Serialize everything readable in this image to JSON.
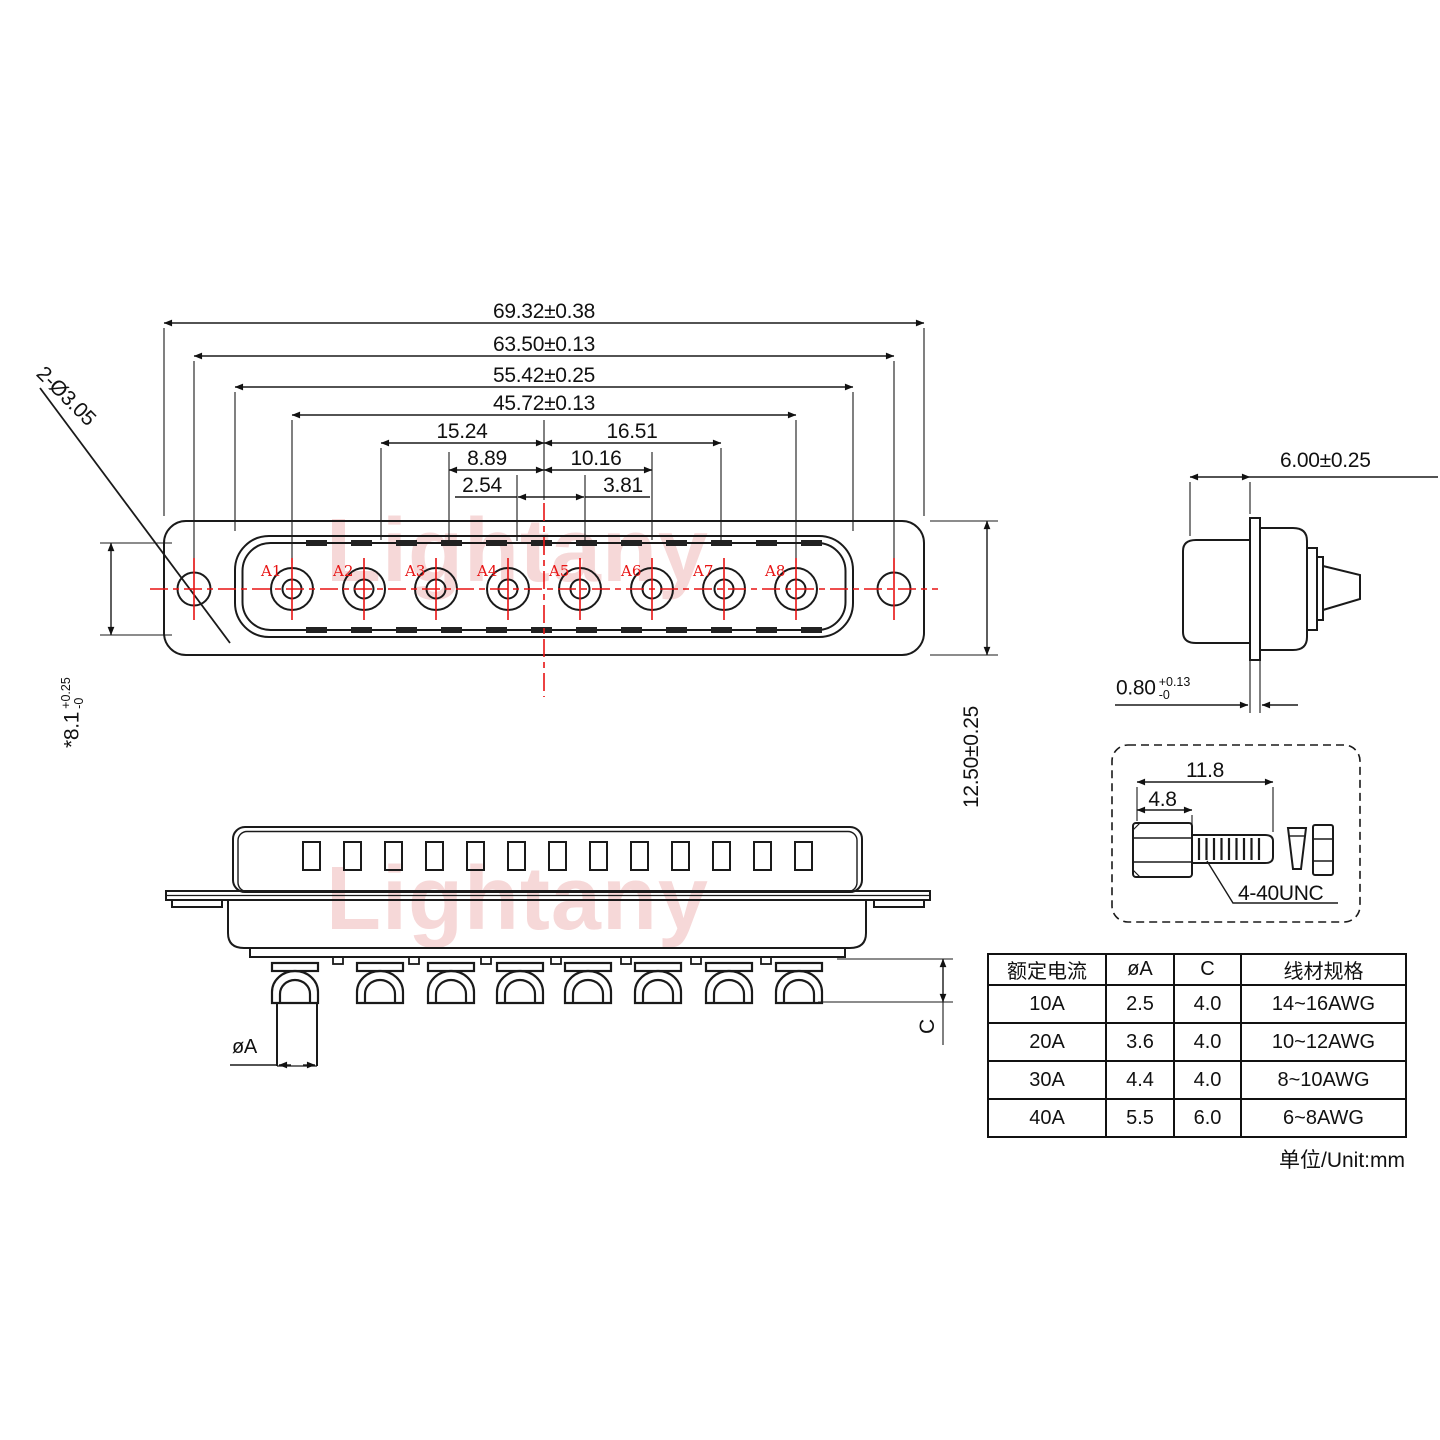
{
  "drawing": {
    "front_view": {
      "dims": {
        "overall": "69.32±0.38",
        "mount": "63.50±0.13",
        "shell": "55.42±0.25",
        "pins_span": "45.72±0.13",
        "p3_left": "15.24",
        "p3_right": "16.51",
        "p2_left": "8.89",
        "p2_right": "10.16",
        "p1_left": "2.54",
        "p1_right": "3.81",
        "mount_holes": "2-Ø3.05",
        "flange_height": "12.50±0.25",
        "shell_height": "*8.1",
        "shell_height_tol_plus": "+0.25",
        "shell_height_tol_minus": "-0"
      },
      "pins": [
        "A1",
        "A2",
        "A3",
        "A4",
        "A5",
        "A6",
        "A7",
        "A8"
      ]
    },
    "side_view": {
      "depth": "6.00±0.25",
      "flange_thickness": "0.80",
      "flange_tol_plus": "+0.13",
      "flange_tol_minus": "-0"
    },
    "screw_detail": {
      "length": "11.8",
      "head_length": "4.8",
      "thread": "4-40UNC"
    },
    "bottom_view": {
      "dia_label": "øA",
      "c_label": "C"
    },
    "table": {
      "headers": [
        "额定电流",
        "øA",
        "C",
        "线材规格"
      ],
      "rows": [
        [
          "10A",
          "2.5",
          "4.0",
          "14~16AWG"
        ],
        [
          "20A",
          "3.6",
          "4.0",
          "10~12AWG"
        ],
        [
          "30A",
          "4.4",
          "4.0",
          "8~10AWG"
        ],
        [
          "40A",
          "5.5",
          "6.0",
          "6~8AWG"
        ]
      ]
    },
    "unit_note": "单位/Unit:mm",
    "watermark": "Lightany",
    "colors": {
      "line": "#1a1a1a",
      "centerline_red": "#e81313",
      "watermark_pink": "#f6d8d8"
    }
  }
}
